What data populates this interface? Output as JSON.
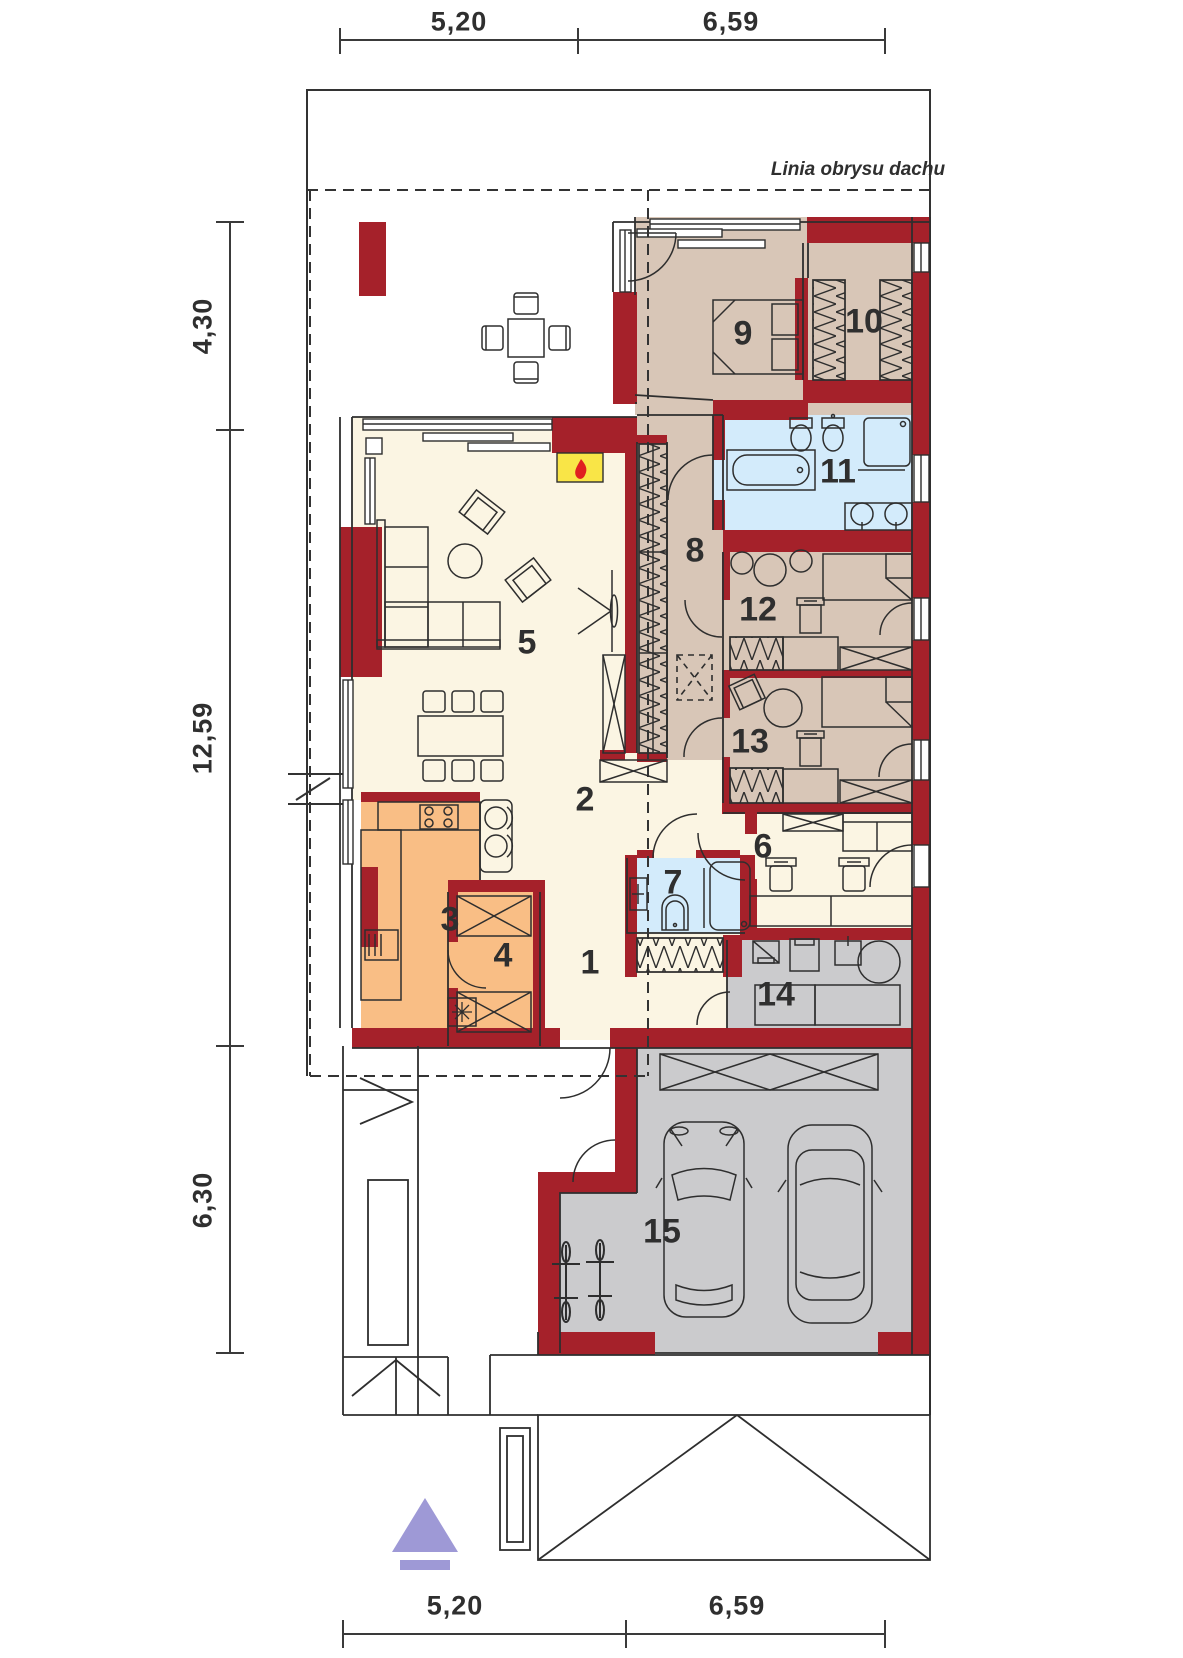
{
  "plan": {
    "roof_line_label": "Linia obrysu dachu",
    "dimensions": {
      "top": [
        {
          "value": "5,20"
        },
        {
          "value": "6,59"
        }
      ],
      "left": [
        {
          "value": "4,30"
        },
        {
          "value": "12,59"
        },
        {
          "value": "6,30"
        }
      ],
      "bottom": [
        {
          "value": "5,20"
        },
        {
          "value": "6,59"
        }
      ]
    },
    "rooms": [
      {
        "number": "1"
      },
      {
        "number": "2"
      },
      {
        "number": "3"
      },
      {
        "number": "4"
      },
      {
        "number": "5"
      },
      {
        "number": "6"
      },
      {
        "number": "7"
      },
      {
        "number": "8"
      },
      {
        "number": "9"
      },
      {
        "number": "10"
      },
      {
        "number": "11"
      },
      {
        "number": "12"
      },
      {
        "number": "13"
      },
      {
        "number": "14"
      },
      {
        "number": "15"
      }
    ],
    "colors": {
      "wall_red": "#a5212a",
      "floor_cream": "#fbf5e3",
      "floor_tan": "#d8c6b7",
      "floor_orange": "#f9be85",
      "floor_blue": "#d3ebfb",
      "floor_gray": "#cbcbcd",
      "fireplace_yellow": "#f9e547",
      "flame_red": "#e02020",
      "north_arrow_purple": "#9e99d6",
      "line": "#2e2e2e"
    }
  }
}
